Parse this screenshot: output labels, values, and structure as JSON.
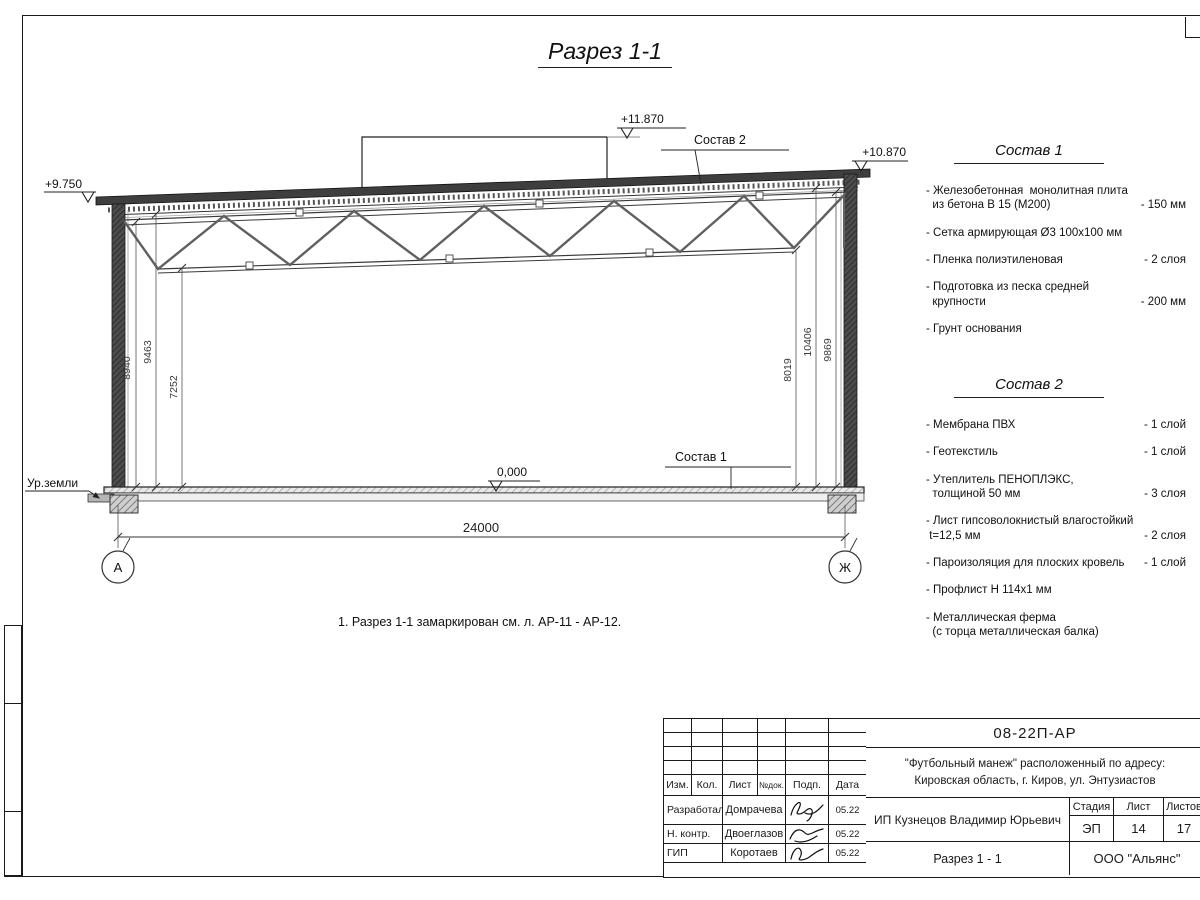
{
  "sheet": {
    "title": "Разрез 1-1",
    "note": "1. Разрез 1-1 замаркирован см. л. АР-11 - АР-12."
  },
  "section": {
    "elev_parapet": "+11.870",
    "elev_roof_right": "+10.870",
    "elev_roof_left": "+9.750",
    "elev_floor": "0,000",
    "ground_label": "Ур.земли",
    "leader_roof": "Состав 2",
    "leader_floor": "Состав 1",
    "span_dim": "24000",
    "dims_left": [
      "8940",
      "9463",
      "7252"
    ],
    "dims_right": [
      "8019",
      "10406",
      "9869"
    ],
    "axis_left": "А",
    "axis_right": "Ж"
  },
  "composition1": {
    "heading": "Состав 1",
    "items": [
      {
        "name": "- Железобетонная  монолитная плита\n  из бетона В 15 (М200)",
        "qty": "- 150 мм"
      },
      {
        "name": "- Сетка армирующая Ø3 100х100 мм",
        "qty": ""
      },
      {
        "name": "- Пленка полиэтиленовая",
        "qty": "-  2 слоя"
      },
      {
        "name": "- Подготовка из песка средней\n  крупности",
        "qty": "- 200 мм"
      },
      {
        "name": "- Грунт основания",
        "qty": ""
      }
    ]
  },
  "composition2": {
    "heading": "Состав 2",
    "items": [
      {
        "name": "- Мембрана ПВХ",
        "qty": "- 1 слой"
      },
      {
        "name": "- Геотекстиль",
        "qty": "- 1 слой"
      },
      {
        "name": "- Утеплитель ПЕНОПЛЭКС,\n  толщиной 50 мм",
        "qty": "- 3 слоя"
      },
      {
        "name": "- Лист гипсоволокнистый влагостойкий\n t=12,5 мм",
        "qty": "- 2 слоя"
      },
      {
        "name": "- Пароизоляция для плоских кровель",
        "qty": "- 1 слой"
      },
      {
        "name": "- Профлист Н 114х1 мм",
        "qty": ""
      },
      {
        "name": "- Металлическая ферма\n  (с торца металлическая балка)",
        "qty": ""
      }
    ]
  },
  "titleblock": {
    "doc_number": "08-22П-АР",
    "project": "\"Футбольный манеж\" расположенный по адресу:\nКировская область, г. Киров, ул. Энтузиастов",
    "columns": [
      "Изм.",
      "Кол.",
      "Лист",
      "№док.",
      "Подп.",
      "Дата"
    ],
    "staff": [
      {
        "role": "Разработал",
        "name": "Домрачева",
        "date": "05.22"
      },
      {
        "role": "Н. контр.",
        "name": "Двоеглазов",
        "date": "05.22"
      },
      {
        "role": "ГИП",
        "name": "Коротаев",
        "date": "05.22"
      }
    ],
    "client": "ИП Кузнецов Владимир Юрьевич",
    "stage_label": "Стадия",
    "sheet_label": "Лист",
    "sheets_label": "Листов",
    "stage": "ЭП",
    "sheet_num": "14",
    "sheets_total": "17",
    "drawing_name": "Разрез 1 - 1",
    "company": "ООО \"Альянс\""
  },
  "colors": {
    "line": "#222222",
    "dark_fill": "#3e3e3e",
    "floor_fill": "#e9e9e9"
  }
}
